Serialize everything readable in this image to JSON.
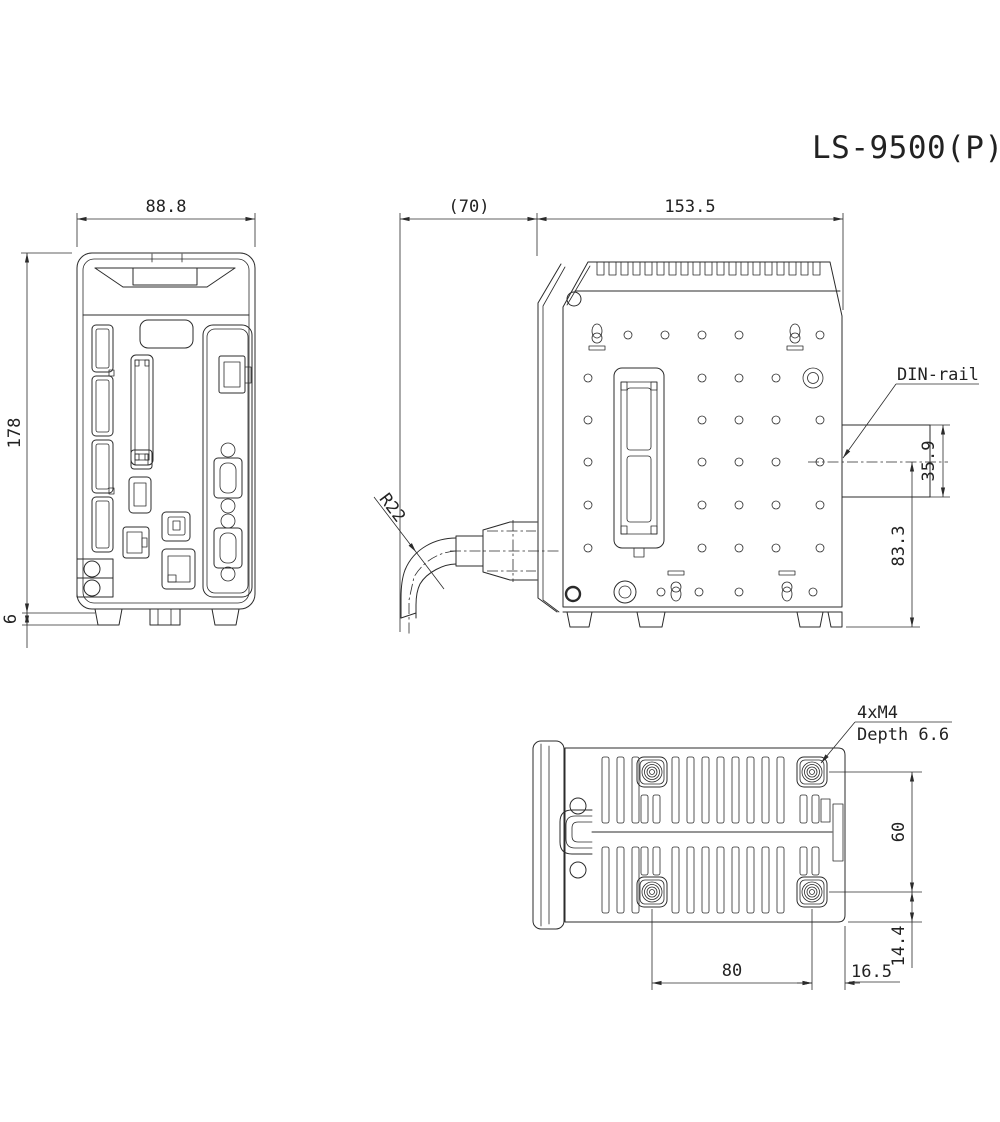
{
  "title": "LS-9500(P)",
  "front_view": {
    "name": "front-view",
    "dim_width": "88.8",
    "dim_height": "178",
    "dim_foot_height": "6"
  },
  "side_view": {
    "name": "side-view",
    "dim_cable_clearance": "(70)",
    "dim_depth": "153.5",
    "label_din_rail": "DIN-rail",
    "dim_din_rail_width": "35.9",
    "dim_din_center_to_bottom": "83.3",
    "label_cable_bend_radius": "R22"
  },
  "bottom_view": {
    "name": "bottom-view",
    "label_mounting_holes": "4xM4",
    "label_hole_depth": "Depth 6.6",
    "dim_hole_span_vertical": "60",
    "dim_hole_to_bottom": "14.4",
    "dim_hole_span_horizontal": "80",
    "dim_hole_to_right": "16.5"
  }
}
